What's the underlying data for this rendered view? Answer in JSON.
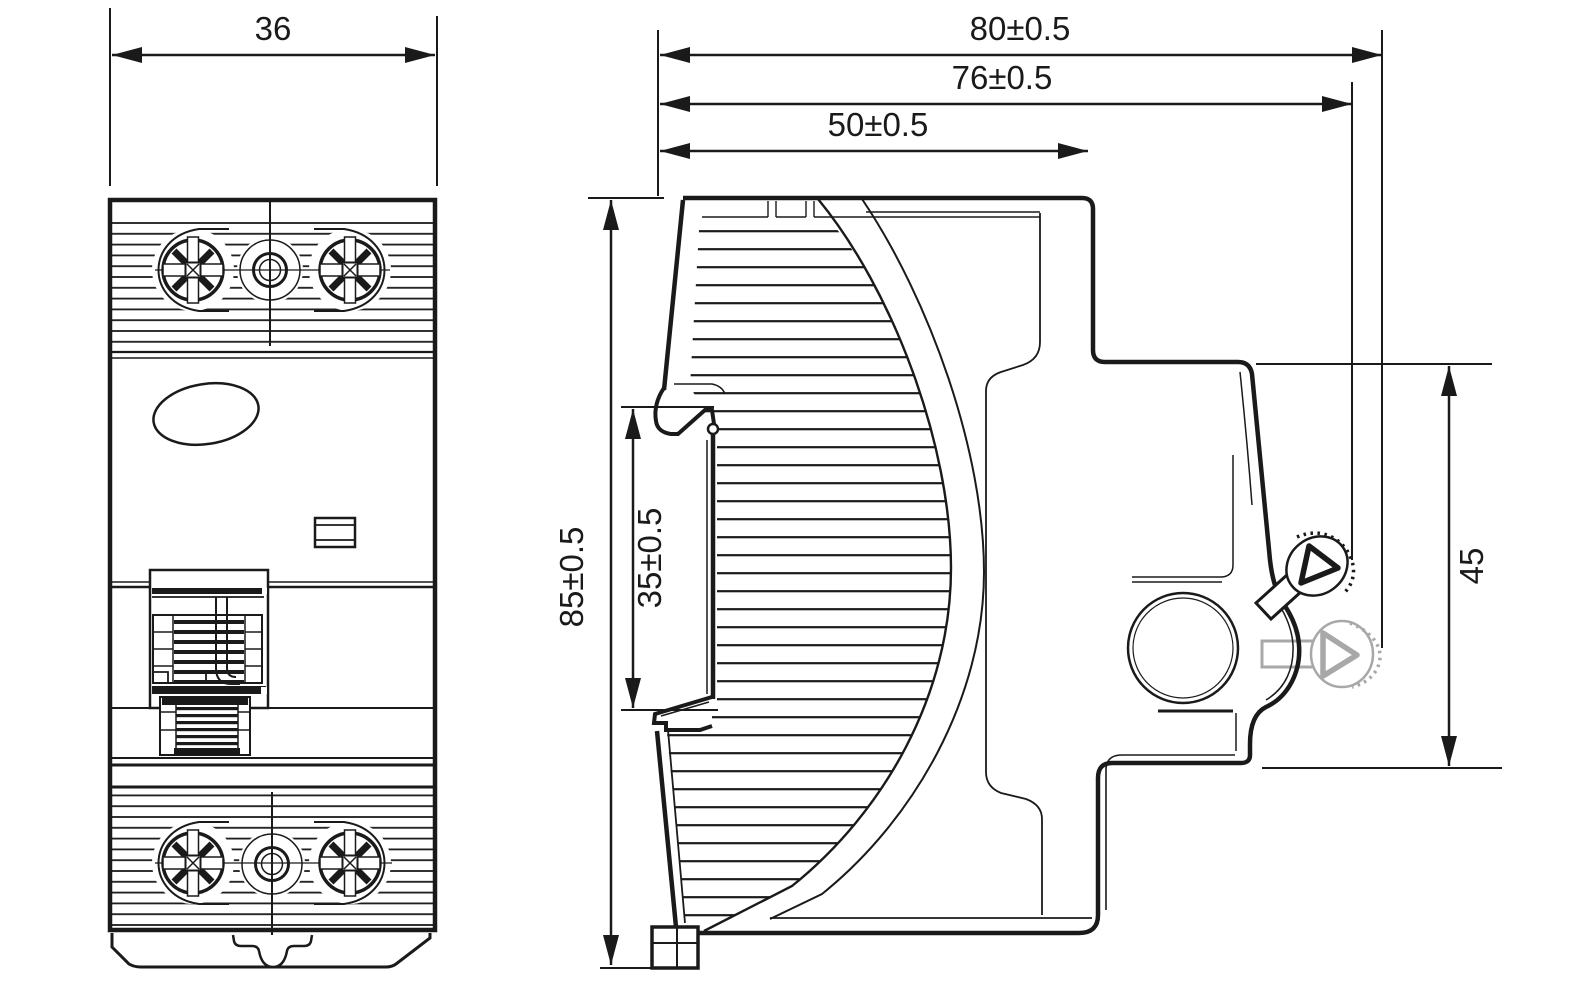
{
  "drawing": {
    "dims": {
      "front_width": "36",
      "overall_depth": "80±0.5",
      "depth_toggle_alt": "76±0.5",
      "body_depth": "50±0.5",
      "overall_height": "85±0.5",
      "din_recess_height": "35±0.5",
      "front_projection": "45"
    },
    "colors": {
      "line": "#1a1a1a",
      "alt_toggle": "#a8a8a8",
      "background": "#ffffff"
    }
  }
}
